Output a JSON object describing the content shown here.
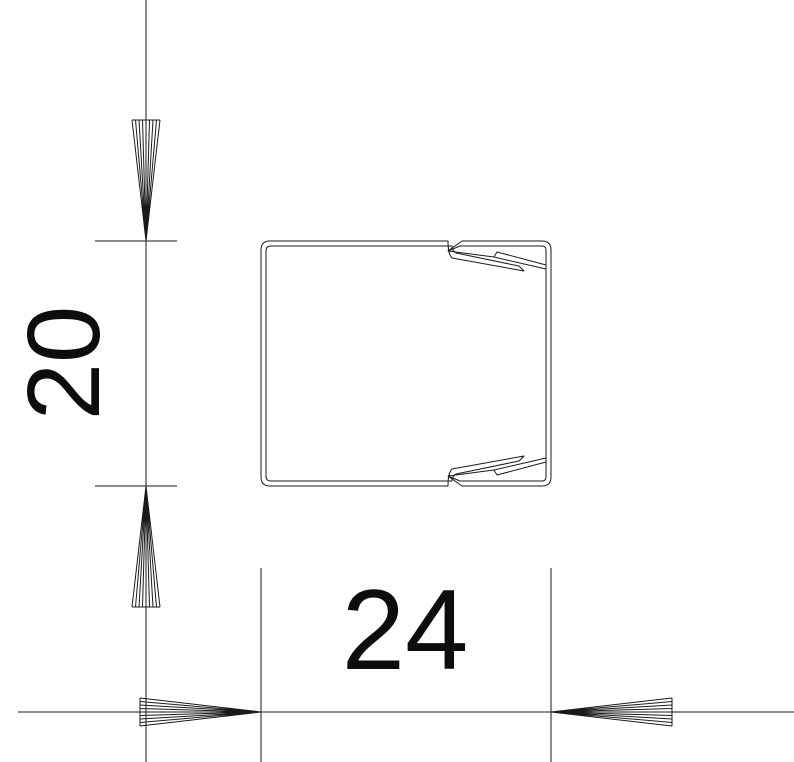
{
  "drawing": {
    "kind": "dimensioned-cross-section",
    "subject": "cable-trunking-profile-with-snap-cover",
    "dimensions": {
      "height": {
        "value": 20,
        "label": "20",
        "orientation": "vertical"
      },
      "width": {
        "value": 24,
        "label": "24",
        "orientation": "horizontal"
      }
    },
    "colors": {
      "background": "#ffffff",
      "lines": "#1a1a1a",
      "text": "#0d0d0d"
    }
  }
}
